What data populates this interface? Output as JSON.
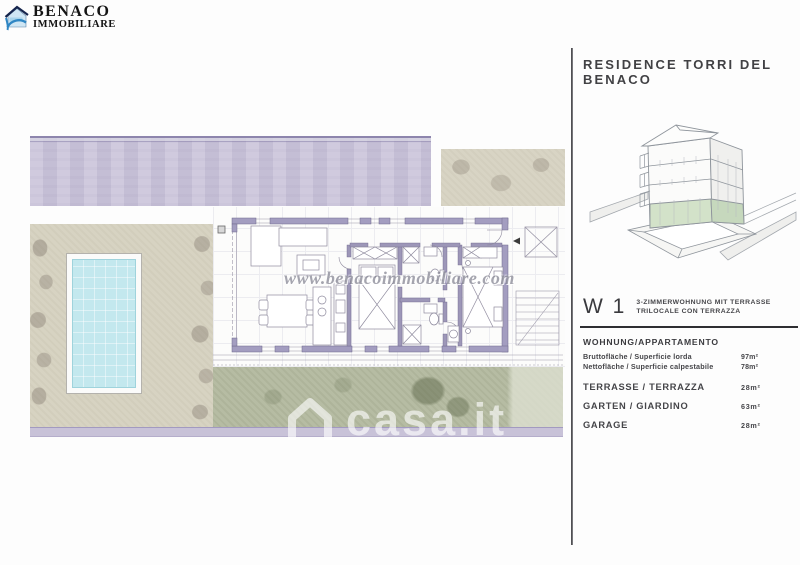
{
  "logo": {
    "name": "BENACO",
    "subname": "IMMOBILIARE"
  },
  "panel": {
    "title": "RESIDENCE TORRI DEL BENACO",
    "unit": {
      "code": "W 1",
      "desc_line1": "3-ZIMMERWOHNUNG MIT TERRASSE",
      "desc_line2": "TRILOCALE CON TERRAZZA"
    },
    "section_header": "WOHNUNG/APPARTAMENTO",
    "rows": [
      {
        "label": "Bruttofläche / Superficie lorda",
        "value": "97m²"
      },
      {
        "label": "Nettofläche / Superficie calpestabile",
        "value": "78m²"
      },
      {
        "label": "TERRASSE / TERRAZZA",
        "value": "28m²"
      },
      {
        "label": "GARTEN / GIARDINO",
        "value": "63m²"
      },
      {
        "label": "GARAGE",
        "value": "28m²"
      }
    ]
  },
  "watermarks": {
    "site": "www.benacoimmobiliare.com",
    "portal": "casa.it"
  },
  "colors": {
    "road_lavender": "#cbc5db",
    "garden_beige": "#d7d3c2",
    "garden_green": "#b6bca3",
    "pool_water": "#c3e8ee",
    "plan_wall": "#a39dc0",
    "ground_floor_green": "#d3e2c9",
    "logo_blue": "#2f86c4",
    "panel_text": "#3c3c40"
  }
}
